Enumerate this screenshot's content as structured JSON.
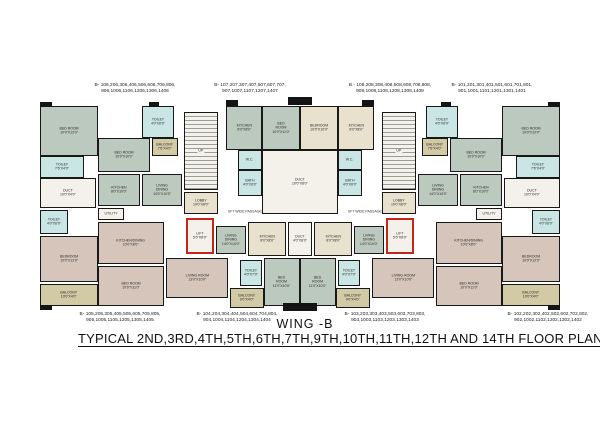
{
  "titles": {
    "wing": "WING -B",
    "plan": "TYPICAL 2ND,3RD,4TH,5TH,6TH,7TH,9TH,10TH,11TH,12TH AND 14TH  FLOOR PLAN"
  },
  "colors": {
    "sage": "#bcc9be",
    "tan": "#d2c9a5",
    "cyan": "#c9e5e4",
    "mauve": "#d6c5ba",
    "cream": "#e7e1cd",
    "white": "#f3f1ea",
    "wall": "#141414",
    "lift_red": "#c2281c"
  },
  "unit_labels": {
    "top": [
      {
        "cx": 135,
        "y": 82,
        "line1": "B- 106,206,306,406,506,606,706,806,",
        "line2": "906,1006,1106,1206,1306,1406"
      },
      {
        "cx": 250,
        "y": 82,
        "line1": "B- 107,207,307,407,507,607,707,",
        "line2": "907,1007,1107,1207,1407"
      },
      {
        "cx": 390,
        "y": 82,
        "line1": "B - 108,208,308,408,508,608,708,808,",
        "line2": "908,1008,1108,1208,1308,1408"
      },
      {
        "cx": 492,
        "y": 82,
        "line1": "B- 101,201,301,401,501,601,701,801,",
        "line2": "901,1001,1101,1201,1301,1401"
      }
    ],
    "bottom": [
      {
        "cx": 120,
        "y": 311,
        "line1": "B- 105,205,305,405,505,605,705,805,",
        "line2": "905,1005,1105,1205,1305,1405"
      },
      {
        "cx": 237,
        "y": 311,
        "line1": "B- 104,204,304,404,504,604,704,804,",
        "line2": "904,1004,1104,1204,1304,1404"
      },
      {
        "cx": 385,
        "y": 311,
        "line1": "B- 103,203,303,403,503,603,703,803,",
        "line2": "903,1003,1103,1203,1303,1403"
      },
      {
        "cx": 548,
        "y": 311,
        "line1": "B- 102,202,302,402,502,602,702,802,",
        "line2": "902,1002,1102,1202,1302,1402"
      }
    ]
  },
  "passages": [
    {
      "cx": 245,
      "y": 208,
      "text": "6FT WIDE PASSAGE"
    },
    {
      "cx": 365,
      "y": 208,
      "text": "6FT WIDE PASSAGE"
    }
  ],
  "rooms": [
    {
      "n": "bedroom-far-left-top",
      "l": "BED ROOM",
      "d": "10'0\"X12'0\"",
      "x": 40,
      "y": 106,
      "w": 58,
      "h": 50,
      "c": "sage"
    },
    {
      "n": "toilet-far-left-top",
      "l": "TOILET",
      "d": "7'6\"X4'0\"",
      "x": 40,
      "y": 156,
      "w": 44,
      "h": 22,
      "c": "cyan"
    },
    {
      "n": "duct-far-left",
      "l": "DUCT",
      "d": "10'0\"X4'0\"",
      "x": 40,
      "y": 178,
      "w": 56,
      "h": 30,
      "c": "white"
    },
    {
      "n": "toilet-far-left-mid",
      "l": "TOILET",
      "d": "4'0\"X6'0\"",
      "x": 40,
      "y": 210,
      "w": 28,
      "h": 24,
      "c": "cyan"
    },
    {
      "n": "bedroom-far-left-bottom",
      "l": "BEDROOM",
      "d": "10'0\"X12'0\"",
      "x": 40,
      "y": 236,
      "w": 58,
      "h": 46,
      "c": "mauve"
    },
    {
      "n": "balcony-far-left-bottom",
      "l": "BALCONY",
      "d": "10'0\"X4'0\"",
      "x": 40,
      "y": 284,
      "w": 58,
      "h": 22,
      "c": "tan"
    },
    {
      "n": "toilet-left-top",
      "l": "TOILET",
      "d": "4'0\"X6'0\"",
      "x": 142,
      "y": 106,
      "w": 32,
      "h": 32,
      "c": "cyan"
    },
    {
      "n": "bedroom-left-top",
      "l": "BED ROOM",
      "d": "10'0\"X10'0\"",
      "x": 98,
      "y": 138,
      "w": 52,
      "h": 34,
      "c": "sage"
    },
    {
      "n": "kitchen-left",
      "l": "KITCHEN",
      "d": "8'0\"X10'0\"",
      "x": 98,
      "y": 174,
      "w": 42,
      "h": 32,
      "c": "sage"
    },
    {
      "n": "utility-left",
      "l": "UTILITY",
      "d": "",
      "x": 98,
      "y": 208,
      "w": 26,
      "h": 12,
      "c": "white"
    },
    {
      "n": "balcony-left-top",
      "l": "BALCONY",
      "d": "7'6\"X4'0\"",
      "x": 152,
      "y": 138,
      "w": 26,
      "h": 18,
      "c": "tan"
    },
    {
      "n": "living-dining-left",
      "l": "LIVING DINING",
      "d": "14'0\"X10'0\"",
      "x": 142,
      "y": 174,
      "w": 40,
      "h": 32,
      "c": "sage"
    },
    {
      "n": "stair-left",
      "l": "UP",
      "d": "",
      "x": 184,
      "y": 112,
      "w": 34,
      "h": 78,
      "c": "stair"
    },
    {
      "n": "lobby-left",
      "l": "LOBBY",
      "d": "10'0\"X8'0\"",
      "x": 184,
      "y": 192,
      "w": 34,
      "h": 22,
      "c": "cream"
    },
    {
      "n": "lift-left",
      "l": "LIFT",
      "d": "5'0\"X8'0\"",
      "x": 186,
      "y": 218,
      "w": 28,
      "h": 36,
      "c": "lift"
    },
    {
      "n": "kitchen-dining-left",
      "l": "KITCHEN/DINING",
      "d": "10'0\"X8'0\"",
      "x": 98,
      "y": 222,
      "w": 66,
      "h": 42,
      "c": "mauve"
    },
    {
      "n": "living-room-left",
      "l": "LIVING ROOM",
      "d": "13'0\"X10'0\"",
      "x": 166,
      "y": 258,
      "w": 62,
      "h": 40,
      "c": "mauve"
    },
    {
      "n": "bedroom-left-bottom",
      "l": "BED ROOM",
      "d": "10'0\"X11'0\"",
      "x": 98,
      "y": 266,
      "w": 66,
      "h": 40,
      "c": "mauve"
    },
    {
      "n": "balcony-left-bottom",
      "l": "BALCONY",
      "d": "9'0\"X4'0\"",
      "x": 230,
      "y": 288,
      "w": 34,
      "h": 20,
      "c": "tan"
    },
    {
      "n": "living-dining-left-lower",
      "l": "LIVING DINING",
      "d": "14'0\"X10'0\"",
      "x": 216,
      "y": 226,
      "w": 30,
      "h": 28,
      "c": "sage"
    },
    {
      "n": "kitchen-center-top-left",
      "l": "KITCHEN",
      "d": "8'0\"X8'0\"",
      "x": 226,
      "y": 106,
      "w": 36,
      "h": 44,
      "c": "sage"
    },
    {
      "n": "bedroom-center-top-left",
      "l": "BED ROOM",
      "d": "10'0\"X11'0\"",
      "x": 262,
      "y": 106,
      "w": 38,
      "h": 44,
      "c": "sage"
    },
    {
      "n": "bedroom-center-top-right",
      "l": "BEDROOM",
      "d": "10'0\"X10'0\"",
      "x": 300,
      "y": 106,
      "w": 38,
      "h": 44,
      "c": "cream"
    },
    {
      "n": "kitchen-center-top-right",
      "l": "KITCHEN",
      "d": "8'0\"X8'0\"",
      "x": 338,
      "y": 106,
      "w": 36,
      "h": 44,
      "c": "cream"
    },
    {
      "n": "wc-left",
      "l": "W.C.",
      "d": "",
      "x": 238,
      "y": 150,
      "w": 24,
      "h": 20,
      "c": "cyan"
    },
    {
      "n": "bath-left",
      "l": "BATH",
      "d": "4'0\"X6'0\"",
      "x": 238,
      "y": 170,
      "w": 24,
      "h": 26,
      "c": "cyan"
    },
    {
      "n": "duct-center",
      "l": "DUCT",
      "d": "10'0\"X8'0\"",
      "x": 262,
      "y": 150,
      "w": 76,
      "h": 64,
      "c": "white"
    },
    {
      "n": "wc-right",
      "l": "W.C.",
      "d": "",
      "x": 338,
      "y": 150,
      "w": 24,
      "h": 20,
      "c": "cyan"
    },
    {
      "n": "bath-right",
      "l": "BATH",
      "d": "4'0\"X6'0\"",
      "x": 338,
      "y": 170,
      "w": 24,
      "h": 26,
      "c": "cyan"
    },
    {
      "n": "kitchen-center-bottom-left",
      "l": "KITCHEN",
      "d": "8'0\"X8'0\"",
      "x": 248,
      "y": 222,
      "w": 38,
      "h": 34,
      "c": "cream"
    },
    {
      "n": "duct-center-bottom",
      "l": "DUCT",
      "d": "4'0\"X8'0\"",
      "x": 288,
      "y": 222,
      "w": 24,
      "h": 34,
      "c": "white"
    },
    {
      "n": "kitchen-center-bottom-right",
      "l": "KITCHEN",
      "d": "8'0\"X8'0\"",
      "x": 314,
      "y": 222,
      "w": 38,
      "h": 34,
      "c": "cream"
    },
    {
      "n": "toilet-center-bottom-left",
      "l": "TOILET",
      "d": "4'0\"X7'0\"",
      "x": 240,
      "y": 260,
      "w": 22,
      "h": 26,
      "c": "cyan"
    },
    {
      "n": "bedroom-center-bottom-left",
      "l": "BED ROOM",
      "d": "11'0\"X10'0\"",
      "x": 264,
      "y": 258,
      "w": 36,
      "h": 48,
      "c": "sage"
    },
    {
      "n": "bedroom-center-bottom-right",
      "l": "BED ROOM",
      "d": "11'0\"X10'0\"",
      "x": 300,
      "y": 258,
      "w": 36,
      "h": 48,
      "c": "sage"
    },
    {
      "n": "toilet-center-bottom-right",
      "l": "TOILET",
      "d": "4'0\"X7'0\"",
      "x": 338,
      "y": 260,
      "w": 22,
      "h": 26,
      "c": "cyan"
    },
    {
      "n": "living-dining-right-lower",
      "l": "LIVING DINING",
      "d": "14'0\"X10'0\"",
      "x": 354,
      "y": 226,
      "w": 30,
      "h": 28,
      "c": "sage"
    },
    {
      "n": "balcony-right-bottom",
      "l": "BALCONY",
      "d": "9'0\"X4'0\"",
      "x": 336,
      "y": 288,
      "w": 34,
      "h": 20,
      "c": "tan"
    },
    {
      "n": "stair-right",
      "l": "UP",
      "d": "",
      "x": 382,
      "y": 112,
      "w": 34,
      "h": 78,
      "c": "stair"
    },
    {
      "n": "lobby-right",
      "l": "LOBBY",
      "d": "10'0\"X8'0\"",
      "x": 382,
      "y": 192,
      "w": 34,
      "h": 22,
      "c": "cream"
    },
    {
      "n": "lift-right",
      "l": "LIFT",
      "d": "5'0\"X8'0\"",
      "x": 386,
      "y": 218,
      "w": 28,
      "h": 36,
      "c": "lift"
    },
    {
      "n": "living-room-right",
      "l": "LIVING ROOM",
      "d": "13'0\"X10'0\"",
      "x": 372,
      "y": 258,
      "w": 62,
      "h": 40,
      "c": "mauve"
    },
    {
      "n": "kitchen-dining-right",
      "l": "KITCHEN/DINING",
      "d": "10'0\"X8'0\"",
      "x": 436,
      "y": 222,
      "w": 66,
      "h": 42,
      "c": "mauve"
    },
    {
      "n": "bedroom-right-bottom",
      "l": "BED ROOM",
      "d": "10'0\"X11'0\"",
      "x": 436,
      "y": 266,
      "w": 66,
      "h": 40,
      "c": "mauve"
    },
    {
      "n": "toilet-right-top",
      "l": "TOILET",
      "d": "4'0\"X6'0\"",
      "x": 426,
      "y": 106,
      "w": 32,
      "h": 32,
      "c": "cyan"
    },
    {
      "n": "bedroom-right-top",
      "l": "BED ROOM",
      "d": "10'0\"X10'0\"",
      "x": 450,
      "y": 138,
      "w": 52,
      "h": 34,
      "c": "sage"
    },
    {
      "n": "kitchen-right",
      "l": "KITCHEN",
      "d": "8'0\"X10'0\"",
      "x": 460,
      "y": 174,
      "w": 42,
      "h": 32,
      "c": "sage"
    },
    {
      "n": "utility-right",
      "l": "UTILITY",
      "d": "",
      "x": 476,
      "y": 208,
      "w": 26,
      "h": 12,
      "c": "white"
    },
    {
      "n": "balcony-right-top",
      "l": "BALCONY",
      "d": "7'6\"X4'0\"",
      "x": 422,
      "y": 138,
      "w": 26,
      "h": 18,
      "c": "tan"
    },
    {
      "n": "living-dining-right",
      "l": "LIVING DINING",
      "d": "14'0\"X10'0\"",
      "x": 418,
      "y": 174,
      "w": 40,
      "h": 32,
      "c": "sage"
    },
    {
      "n": "bedroom-far-right-top",
      "l": "BED ROOM",
      "d": "10'0\"X12'0\"",
      "x": 502,
      "y": 106,
      "w": 58,
      "h": 50,
      "c": "sage"
    },
    {
      "n": "toilet-far-right-top",
      "l": "TOILET",
      "d": "7'6\"X4'0\"",
      "x": 516,
      "y": 156,
      "w": 44,
      "h": 22,
      "c": "cyan"
    },
    {
      "n": "duct-far-right",
      "l": "DUCT",
      "d": "10'0\"X4'0\"",
      "x": 504,
      "y": 178,
      "w": 56,
      "h": 30,
      "c": "white"
    },
    {
      "n": "toilet-far-right-mid",
      "l": "TOILET",
      "d": "4'0\"X6'0\"",
      "x": 532,
      "y": 210,
      "w": 28,
      "h": 24,
      "c": "cyan"
    },
    {
      "n": "bedroom-far-right-bottom",
      "l": "BEDROOM",
      "d": "10'0\"X12'0\"",
      "x": 502,
      "y": 236,
      "w": 58,
      "h": 46,
      "c": "mauve"
    },
    {
      "n": "balcony-far-right-bottom",
      "l": "BALCONY",
      "d": "10'0\"X4'0\"",
      "x": 502,
      "y": 284,
      "w": 58,
      "h": 22,
      "c": "tan"
    }
  ],
  "wall_tabs": [
    {
      "x": 288,
      "y": 97,
      "w": 24,
      "h": 8
    },
    {
      "x": 226,
      "y": 100,
      "w": 12,
      "h": 6
    },
    {
      "x": 362,
      "y": 100,
      "w": 12,
      "h": 6
    },
    {
      "x": 149,
      "y": 102,
      "w": 10,
      "h": 5
    },
    {
      "x": 441,
      "y": 102,
      "w": 10,
      "h": 5
    },
    {
      "x": 283,
      "y": 303,
      "w": 34,
      "h": 8
    },
    {
      "x": 40,
      "y": 102,
      "w": 12,
      "h": 5
    },
    {
      "x": 548,
      "y": 102,
      "w": 12,
      "h": 5
    },
    {
      "x": 40,
      "y": 305,
      "w": 12,
      "h": 5
    },
    {
      "x": 548,
      "y": 305,
      "w": 12,
      "h": 5
    }
  ]
}
